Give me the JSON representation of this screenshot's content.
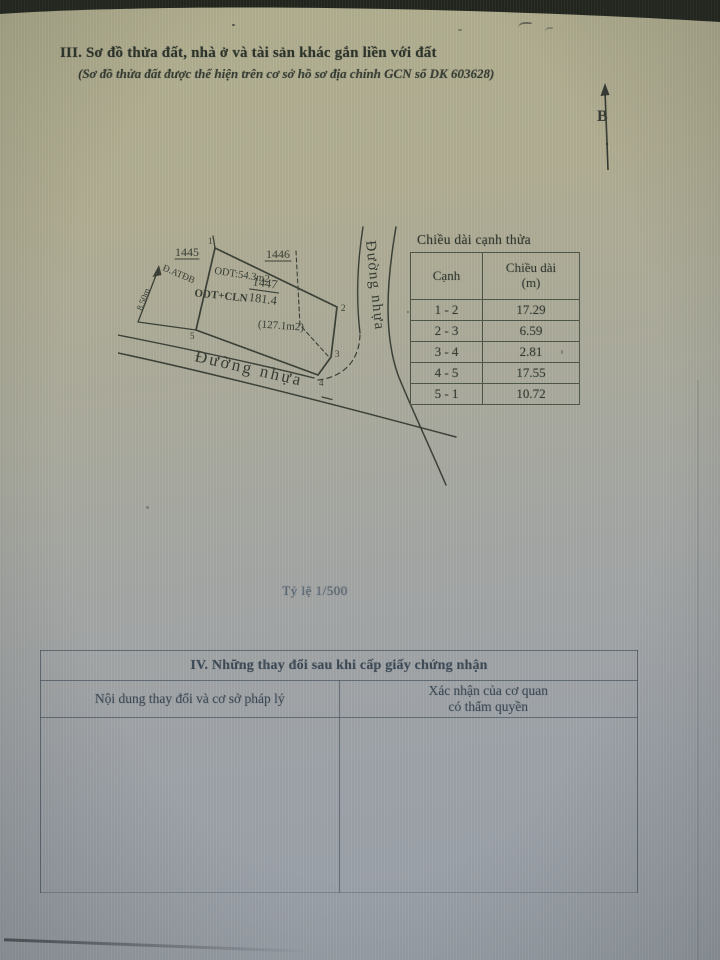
{
  "document": {
    "title": "III. Sơ đồ thửa đất, nhà ở và tài sản khác gắn liền với đất",
    "subtitle": "(Sơ đồ thửa đất được thể hiện trên cơ sở hồ sơ địa chính GCN số DK 603628)",
    "scale_note": "Tỷ lệ 1/500",
    "north_label": "B"
  },
  "diagram": {
    "adjacent_plot_left": "1445",
    "adjacent_plot_right": "1446",
    "parcel_number": "1447",
    "parcel_area_m2": "181.4",
    "land_use_code": "ODT+CLN",
    "odt_portion_label": "ODT:54.3m2",
    "cln_portion_label": "(127.1m2)",
    "edge_dim_label": "8.50m",
    "easement_label": "Đ.ATĐB",
    "road_bottom_label": "Đường nhựa",
    "road_right_label": "Đường nhựa",
    "vertex_labels": [
      "1",
      "2",
      "3",
      "4",
      "5"
    ]
  },
  "edge_table": {
    "title": "Chiều dài cạnh thửa",
    "header_edge": "Cạnh",
    "header_length_line1": "Chiều dài",
    "header_length_line2": "(m)",
    "rows": [
      {
        "edge": "1 - 2",
        "length_m": "17.29"
      },
      {
        "edge": "2 - 3",
        "length_m": "6.59"
      },
      {
        "edge": "3 - 4",
        "length_m": "2.81"
      },
      {
        "edge": "4 - 5",
        "length_m": "17.55"
      },
      {
        "edge": "5 - 1",
        "length_m": "10.72"
      }
    ]
  },
  "changes_table": {
    "title": "IV. Những thay đổi sau khi cấp giấy chứng nhận",
    "col_content": "Nội dung thay đổi và cơ sở pháp lý",
    "col_confirm_line1": "Xác nhận của cơ quan",
    "col_confirm_line2": "có thẩm quyền"
  }
}
